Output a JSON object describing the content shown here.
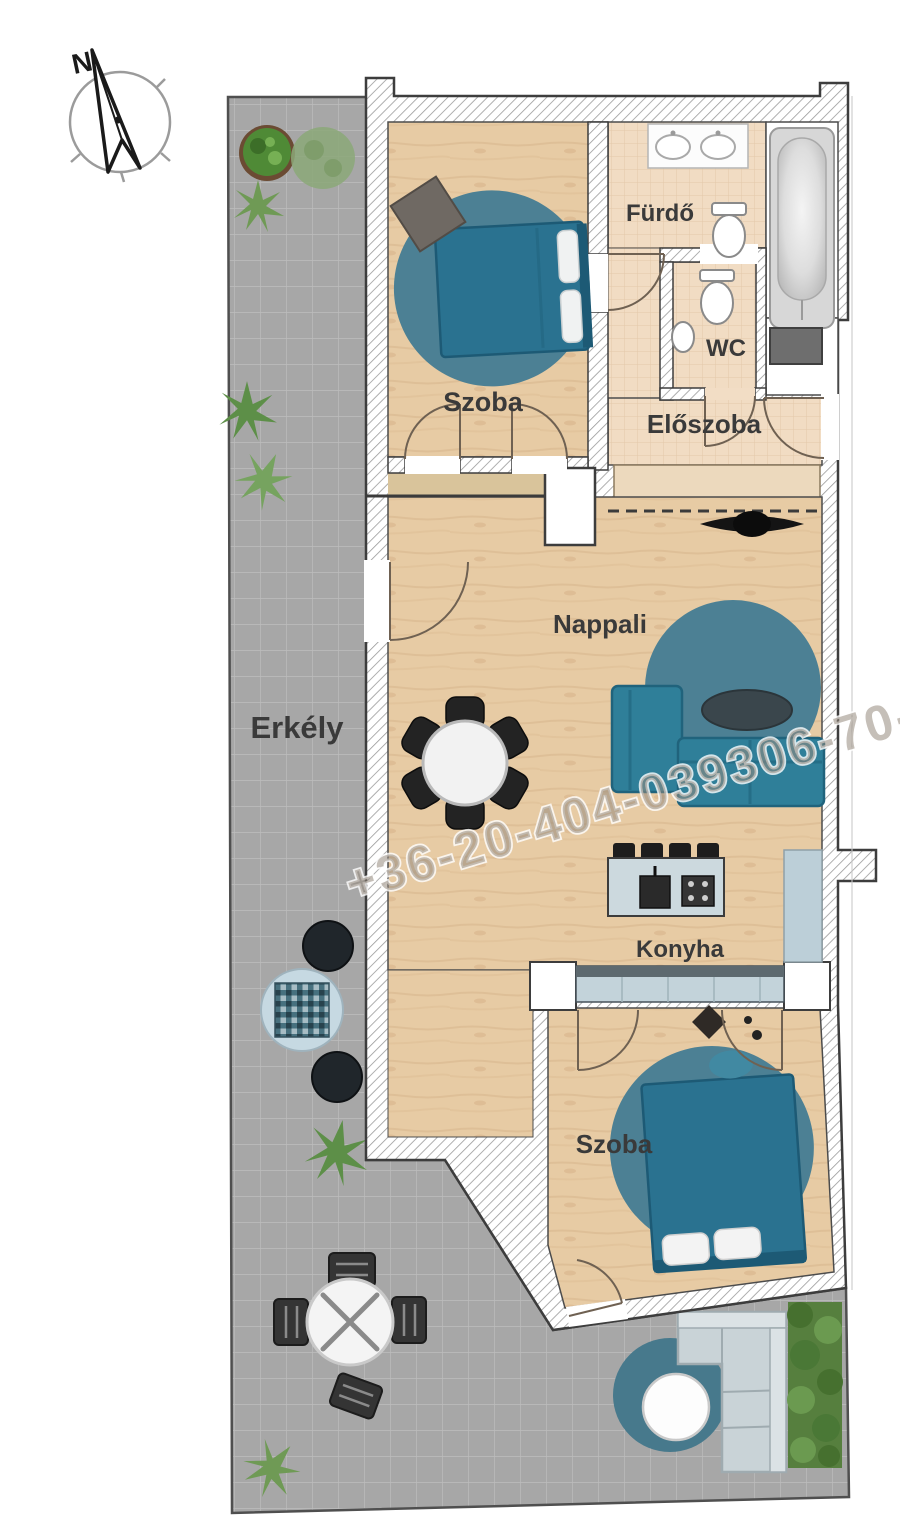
{
  "labels": {
    "szoba_top": "Szoba",
    "furdo": "Fürdő",
    "wc": "WC",
    "eloszoba": "Előszoba",
    "nappali": "Nappali",
    "erkely": "Erkély",
    "konyha": "Konyha",
    "szoba_bottom": "Szoba"
  },
  "compass": {
    "north": "N"
  },
  "watermark": {
    "text": "+36-20-404-039306-70-44"
  },
  "palette": {
    "wall_outline": "#3d3d3d",
    "wood_floor": "#e7cba4",
    "tile_floor": "#f1dcc3",
    "balcony_gray": "#a7a7a7",
    "furniture_teal": "#2a7290",
    "rug_teal": "#4c8094",
    "counter_blue": "#c3d3da",
    "outdoor_sofa_gray": "#c9d3d7",
    "plant_green": "#5d8f48",
    "watermark_gray": "#968b7f"
  }
}
